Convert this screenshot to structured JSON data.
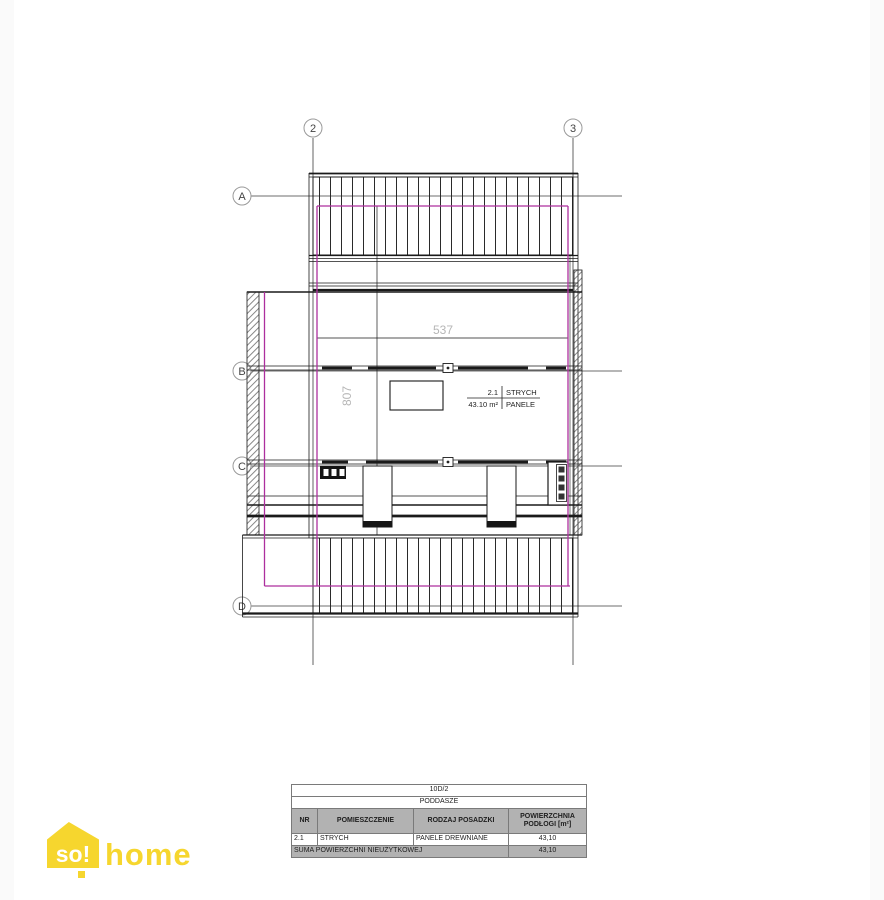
{
  "page": {
    "background": "#ffffff"
  },
  "drawing": {
    "grid": {
      "cols": [
        {
          "label": "2"
        },
        {
          "label": "3"
        }
      ],
      "rows": [
        {
          "label": "A"
        },
        {
          "label": "B"
        },
        {
          "label": "C"
        },
        {
          "label": "D"
        }
      ]
    },
    "dimensions": {
      "width_label": "537",
      "height_label": "807"
    },
    "room_stamp": {
      "number": "2.1",
      "name": "STRYCH",
      "area": "43.10 m²",
      "floor": "PANELE"
    },
    "accent_color": "#ad2f9e"
  },
  "table": {
    "project_id": "10D/2",
    "level_name": "PODDASZE",
    "headers": {
      "nr": "NR",
      "room": "POMIESZCZENIE",
      "floor_type": "RODZAJ POSADZKI",
      "area": "POWIERZCHNIA PODŁOGI [m²]"
    },
    "rows": [
      {
        "nr": "2.1",
        "room": "STRYCH",
        "floor_type": "PANELE DREWNIANE",
        "area": "43,10"
      }
    ],
    "footer": {
      "label": "SUMA POWIERZCHNI NIEUŻYTKOWEJ",
      "value": "43,10"
    }
  },
  "logo": {
    "brand_prefix": "so!",
    "brand_suffix": "home",
    "color": "#f6d62e"
  }
}
